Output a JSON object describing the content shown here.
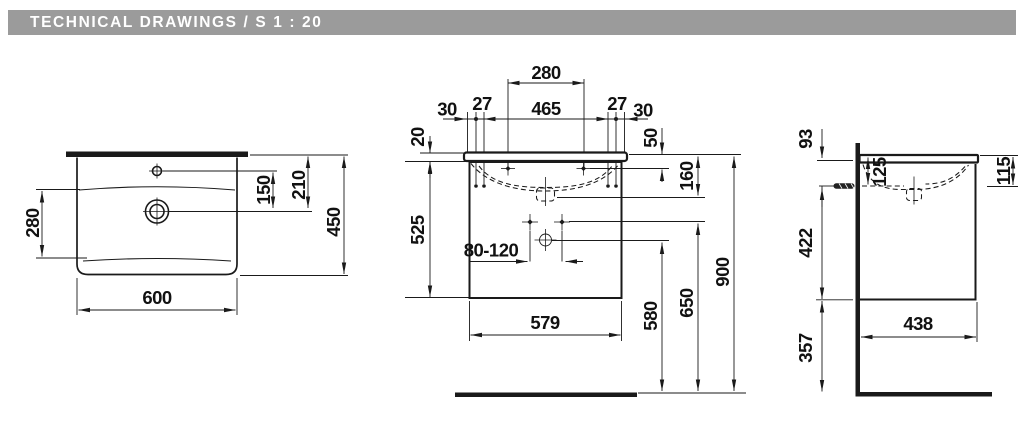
{
  "header": {
    "title": "TECHNICAL DRAWINGS / S 1 : 20"
  },
  "colors": {
    "header_bg": "#9b9b9b",
    "header_text": "#ffffff",
    "line_color": "#1a1a1a",
    "background": "#ffffff"
  },
  "views": {
    "top": {
      "dim_600": "600",
      "dim_280": "280",
      "dim_150": "150",
      "dim_210": "210",
      "dim_450": "450"
    },
    "front": {
      "dim_280": "280",
      "dim_30_left": "30",
      "dim_27_left": "27",
      "dim_465": "465",
      "dim_27_right": "27",
      "dim_30_right": "30",
      "dim_20": "20",
      "dim_50": "50",
      "dim_160": "160",
      "dim_525": "525",
      "dim_80_120": "80-120",
      "dim_579": "579",
      "dim_580": "580",
      "dim_650": "650",
      "dim_900": "900"
    },
    "side": {
      "dim_93": "93",
      "dim_125": "125",
      "dim_115": "115",
      "dim_422": "422",
      "dim_438": "438",
      "dim_357": "357"
    }
  }
}
